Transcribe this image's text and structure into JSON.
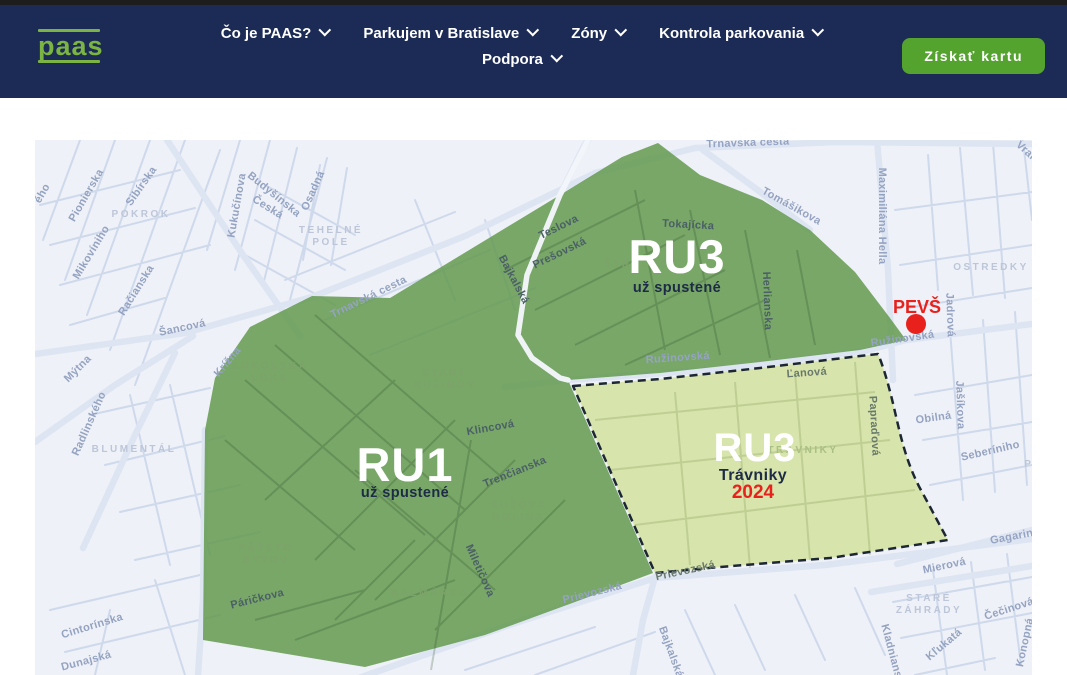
{
  "header": {
    "logo": "paas",
    "nav": [
      {
        "label": "Čo je PAAS?"
      },
      {
        "label": "Parkujem v Bratislave"
      },
      {
        "label": "Zóny"
      },
      {
        "label": "Kontrola parkovania"
      },
      {
        "label": "Podpora"
      }
    ],
    "cta_label": "Získať kartu",
    "colors": {
      "bg": "#1b2b55",
      "logo_green": "#7cb443",
      "button_green": "#55a32f"
    }
  },
  "map": {
    "zones": [
      {
        "code": "RU3",
        "status": "už spustené",
        "fill": "#669b53"
      },
      {
        "code": "RU1",
        "status": "už spustené",
        "fill": "#669b53"
      },
      {
        "code": "RU3",
        "name": "Trávniky",
        "year": "2024",
        "fill": "#d5e3a5",
        "border": "dashed"
      }
    ],
    "marker": {
      "label": "PEVŠ",
      "color": "#e8211d"
    },
    "labels": [
      {
        "t": "Pionierska",
        "x": 54,
        "y": 57,
        "r": -60,
        "c": "st"
      },
      {
        "t": "Sibírska",
        "x": 109,
        "y": 48,
        "r": -55,
        "c": "st"
      },
      {
        "t": "Mikovíniho",
        "x": 59,
        "y": 114,
        "r": -59,
        "c": "st"
      },
      {
        "t": "Račianska",
        "x": 104,
        "y": 152,
        "r": -58,
        "c": "st"
      },
      {
        "t": "Kukučínova",
        "x": 205,
        "y": 66,
        "r": -80,
        "c": "st"
      },
      {
        "t": "Budyšínska",
        "x": 237,
        "y": 57,
        "r": 39,
        "c": "st"
      },
      {
        "t": "Česká",
        "x": 231,
        "y": 70,
        "r": 32,
        "c": "st"
      },
      {
        "t": "Osadná",
        "x": 281,
        "y": 52,
        "r": -66,
        "c": "st"
      },
      {
        "t": "Šancová",
        "x": 148,
        "y": 191,
        "r": -12,
        "c": "st"
      },
      {
        "t": "Mýtna",
        "x": 45,
        "y": 231,
        "r": -45,
        "c": "st"
      },
      {
        "t": "Radlinského",
        "x": 57,
        "y": 285,
        "r": -66,
        "c": "st"
      },
      {
        "t": "Krížna",
        "x": 195,
        "y": 224,
        "r": -50,
        "c": "st"
      },
      {
        "t": "Trnavská cesta",
        "x": 335,
        "y": 160,
        "r": -26,
        "c": "st"
      },
      {
        "t": "Trnavská cesta",
        "x": 713,
        "y": 6,
        "r": -2,
        "c": "st"
      },
      {
        "t": "Tomášikova",
        "x": 755,
        "y": 69,
        "r": 29,
        "c": "st"
      },
      {
        "t": "Maximiliána Hella",
        "x": 844,
        "y": 76,
        "r": 90,
        "c": "st"
      },
      {
        "t": "Vrakunská",
        "x": 1002,
        "y": 25,
        "r": 42,
        "c": "st"
      },
      {
        "t": "Jadrová",
        "x": 912,
        "y": 175,
        "r": 88,
        "c": "st"
      },
      {
        "t": "Ružinovská",
        "x": 868,
        "y": 202,
        "r": -8,
        "c": "st"
      },
      {
        "t": "Ružinovská",
        "x": 643,
        "y": 221,
        "r": -4,
        "c": "st"
      },
      {
        "t": "Obilná",
        "x": 899,
        "y": 281,
        "r": -8,
        "c": "st"
      },
      {
        "t": "Jašíkova",
        "x": 922,
        "y": 265,
        "r": 88,
        "c": "st"
      },
      {
        "t": "Seberíniho",
        "x": 956,
        "y": 314,
        "r": -13,
        "c": "st"
      },
      {
        "t": "Gagarinova",
        "x": 987,
        "y": 398,
        "r": -11,
        "c": "st"
      },
      {
        "t": "Mierová",
        "x": 910,
        "y": 429,
        "r": -12,
        "c": "st"
      },
      {
        "t": "Čečinová",
        "x": 975,
        "y": 472,
        "r": -18,
        "c": "st"
      },
      {
        "t": "Konopná",
        "x": 993,
        "y": 503,
        "r": -78,
        "c": "st"
      },
      {
        "t": "Kľukatá",
        "x": 911,
        "y": 507,
        "r": -40,
        "c": "st"
      },
      {
        "t": "Kladnianska",
        "x": 855,
        "y": 518,
        "r": 75,
        "c": "st"
      },
      {
        "t": "Cintorínska",
        "x": 58,
        "y": 489,
        "r": -17,
        "c": "st"
      },
      {
        "t": "Dunajská",
        "x": 52,
        "y": 524,
        "r": -15,
        "c": "st"
      },
      {
        "t": "Prievozská",
        "x": 558,
        "y": 456,
        "r": -14,
        "c": "st"
      },
      {
        "t": "Bajkalská",
        "x": 633,
        "y": 513,
        "r": 70,
        "c": "st"
      },
      {
        "t": "ého",
        "x": 10,
        "y": 55,
        "r": -60,
        "c": "st"
      },
      {
        "t": "Teslova",
        "x": 525,
        "y": 90,
        "r": -26,
        "c": "stg"
      },
      {
        "t": "Prešovská",
        "x": 526,
        "y": 116,
        "r": -26,
        "c": "stg"
      },
      {
        "t": "Tokajícka",
        "x": 653,
        "y": 88,
        "r": 3,
        "c": "stg"
      },
      {
        "t": "Herlianska",
        "x": 729,
        "y": 161,
        "r": 88,
        "c": "stg"
      },
      {
        "t": "Bajkalská",
        "x": 476,
        "y": 141,
        "r": 62,
        "c": "stg"
      },
      {
        "t": "Klincová",
        "x": 456,
        "y": 291,
        "r": -10,
        "c": "stg"
      },
      {
        "t": "Trenčianska",
        "x": 481,
        "y": 335,
        "r": -22,
        "c": "stg"
      },
      {
        "t": "Miletičova",
        "x": 442,
        "y": 432,
        "r": 66,
        "c": "stg"
      },
      {
        "t": "Páričkova",
        "x": 223,
        "y": 462,
        "r": -14,
        "c": "stg"
      },
      {
        "t": "Ľanová",
        "x": 772,
        "y": 236,
        "r": -4,
        "c": "stl"
      },
      {
        "t": "Papraďová",
        "x": 836,
        "y": 286,
        "r": 87,
        "c": "stl"
      },
      {
        "t": "Prievozská",
        "x": 651,
        "y": 434,
        "r": -12,
        "c": "stl"
      },
      {
        "t": "POKROK",
        "x": 106,
        "y": 77,
        "r": 0,
        "c": "ar"
      },
      {
        "t": "TEHELNÉ",
        "x": 296,
        "y": 93,
        "r": 0,
        "c": "ar"
      },
      {
        "t": "POLE",
        "x": 296,
        "y": 105,
        "r": 0,
        "c": "ar"
      },
      {
        "t": "OSTREDKY",
        "x": 956,
        "y": 130,
        "r": 0,
        "c": "ar"
      },
      {
        "t": "BLUMENTÁL",
        "x": 99,
        "y": 312,
        "r": 0,
        "c": "ar"
      },
      {
        "t": "STARÉ",
        "x": 894,
        "y": 461,
        "r": 0,
        "c": "ar"
      },
      {
        "t": "ZÁHRADY",
        "x": 894,
        "y": 473,
        "r": 0,
        "c": "ar"
      },
      {
        "t": "POŠEŇ",
        "x": 1013,
        "y": 327,
        "r": 0,
        "c": "ar"
      },
      {
        "t": "SOKOLSKÁ",
        "x": 235,
        "y": 229,
        "r": 0,
        "c": "arg"
      },
      {
        "t": "LÚKA",
        "x": 235,
        "y": 241,
        "r": 0,
        "c": "arg"
      },
      {
        "t": "STARÝ",
        "x": 410,
        "y": 236,
        "r": 0,
        "c": "arg"
      },
      {
        "t": "RUŽINOV",
        "x": 410,
        "y": 248,
        "r": 0,
        "c": "arg"
      },
      {
        "t": "RUŽOVÁ",
        "x": 484,
        "y": 368,
        "r": 0,
        "c": "arg"
      },
      {
        "t": "DOLINA",
        "x": 484,
        "y": 380,
        "r": 0,
        "c": "arg"
      },
      {
        "t": "PÄŤSTO",
        "x": 231,
        "y": 411,
        "r": 0,
        "c": "arg"
      },
      {
        "t": "BYTOV",
        "x": 231,
        "y": 423,
        "r": 0,
        "c": "arg"
      },
      {
        "t": "KALMÁRKA",
        "x": 395,
        "y": 456,
        "r": 0,
        "c": "arg"
      },
      {
        "t": "ŠTRKOVEC",
        "x": 607,
        "y": 127,
        "r": 0,
        "c": "arg"
      },
      {
        "t": "TRÁVNIKY",
        "x": 768,
        "y": 313,
        "r": 0,
        "c": "arl"
      }
    ]
  }
}
